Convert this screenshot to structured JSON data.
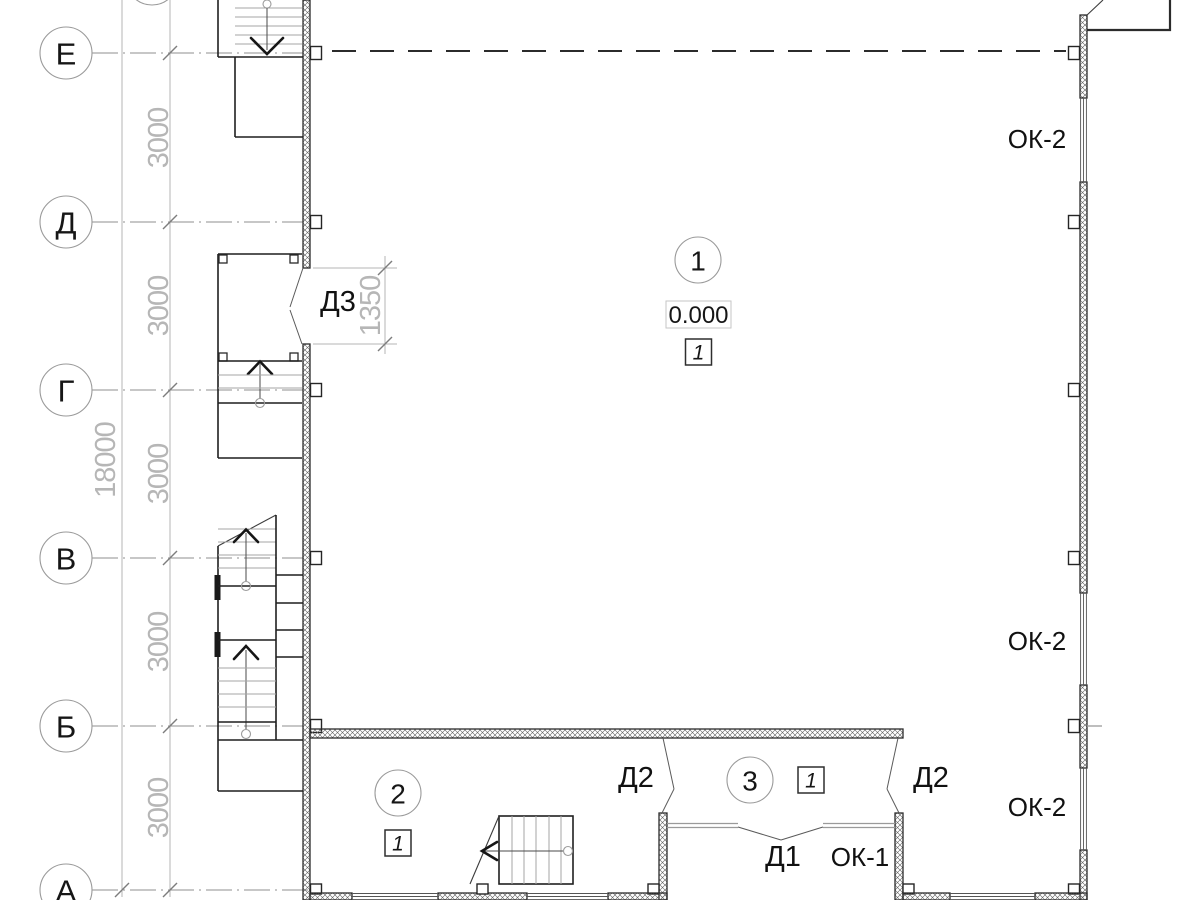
{
  "axes": [
    {
      "label": "Е"
    },
    {
      "label": "Д"
    },
    {
      "label": "Г"
    },
    {
      "label": "В"
    },
    {
      "label": "Б"
    },
    {
      "label": "А"
    }
  ],
  "dimensions": {
    "spacing": [
      "3000",
      "3000",
      "3000",
      "3000",
      "3000"
    ],
    "total": "18000",
    "door_opening": "1350"
  },
  "rooms": [
    {
      "number": "1",
      "elevation": "0.000",
      "floor_mark": "1"
    },
    {
      "number": "2",
      "floor_mark": "1"
    },
    {
      "number": "3",
      "floor_mark": "1"
    }
  ],
  "doors": {
    "d3": "Д3",
    "d2_left": "Д2",
    "d2_right": "Д2",
    "d1": "Д1"
  },
  "windows": {
    "ok2_top": "ОК-2",
    "ok2_mid": "ОК-2",
    "ok2_low": "ОК-2",
    "ok1": "ОК-1"
  },
  "colors": {
    "line": "#2b2b2b",
    "dimension": "#b6b6b6",
    "axis_line": "#8f8f8f",
    "steps": "#a6a6a6",
    "hatch": "#5f5f5f"
  }
}
